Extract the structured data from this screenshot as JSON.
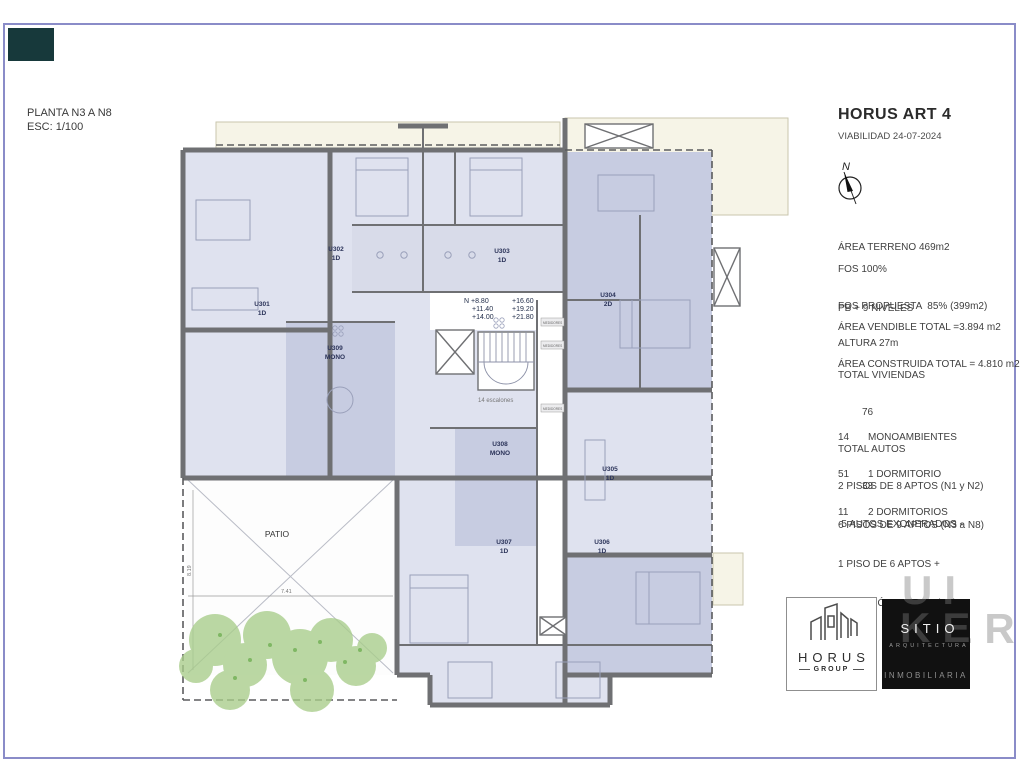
{
  "page": {
    "plan_title": "PLANTA N3 A N8",
    "plan_scale": "ESC: 1/100"
  },
  "titleblock": {
    "project": "HORUS ART 4",
    "date_line": "VIABILIDAD 24-07-2024",
    "north": "N",
    "site": {
      "area_terreno": "ÁREA TERRENO 469m2",
      "fos": "FOS 100%",
      "fos_propuesta": "FOS PROPUESTA  85% (399m2)",
      "altura": "ALTURA 27m",
      "niveles": "PB + 9 NIVELES",
      "area_vendible": "ÁREA VENDIBLE TOTAL =3.894 m2",
      "area_construida": "ÁREA CONSTRUIDA TOTAL = 4.810 m2"
    },
    "totals": {
      "viviendas_label": "TOTAL VIVIENDAS",
      "viviendas_value": "76",
      "autos_label": "TOTAL AUTOS",
      "autos_value": "33",
      "exonerados": "-5 AUTOS EXONERADOS -"
    },
    "unit_mix": [
      {
        "count": "14",
        "label": "MONOAMBIENTES"
      },
      {
        "count": "51",
        "label": "1 DORMITORIO"
      },
      {
        "count": "11",
        "label": "2 DORMITORIOS"
      }
    ],
    "floors": [
      "2 PISOS DE 8 APTOS (N1 y N2)",
      "6 PISOS DE 9 APTOS (N3 a N8)",
      "1 PISO DE 6 APTOS +",
      "PREVISIÓN DE SUM (N9)"
    ]
  },
  "plan": {
    "units": [
      {
        "id": "U301",
        "type": "1D"
      },
      {
        "id": "U302",
        "type": "1D"
      },
      {
        "id": "U303",
        "type": "1D"
      },
      {
        "id": "U304",
        "type": "2D"
      },
      {
        "id": "U305",
        "type": "1D"
      },
      {
        "id": "U306",
        "type": "1D"
      },
      {
        "id": "U307",
        "type": "1D"
      },
      {
        "id": "U308",
        "type": "MONO"
      },
      {
        "id": "U309",
        "type": "MONO"
      }
    ],
    "levels_left": [
      "N +8.80",
      "+11.40",
      "+14.00"
    ],
    "levels_right": [
      "+16.60",
      "+19.20",
      "+21.80"
    ],
    "stairs_note": "14  escalones",
    "patio": "PATIO",
    "dim_w": "7.41",
    "dim_h": "8.19",
    "meters": "MEDIDORES"
  },
  "logos": {
    "horus_name": "HORUS",
    "horus_sub": "GROUP",
    "sitio_name": "SITIO",
    "sitio_sub1": "ARQUITECTURA",
    "sitio_sub2": "INMOBILIARIA",
    "watermark_line1": "UI",
    "watermark_line2": "KER"
  },
  "colors": {
    "border": "#8a8cc8",
    "room_light": "#dfe2ef",
    "room_dark": "#c7cce1",
    "wall": "#6f7073",
    "balcony": "#f6f4e7",
    "tree": "#a8cd8a",
    "accent_dark": "#17393b"
  }
}
